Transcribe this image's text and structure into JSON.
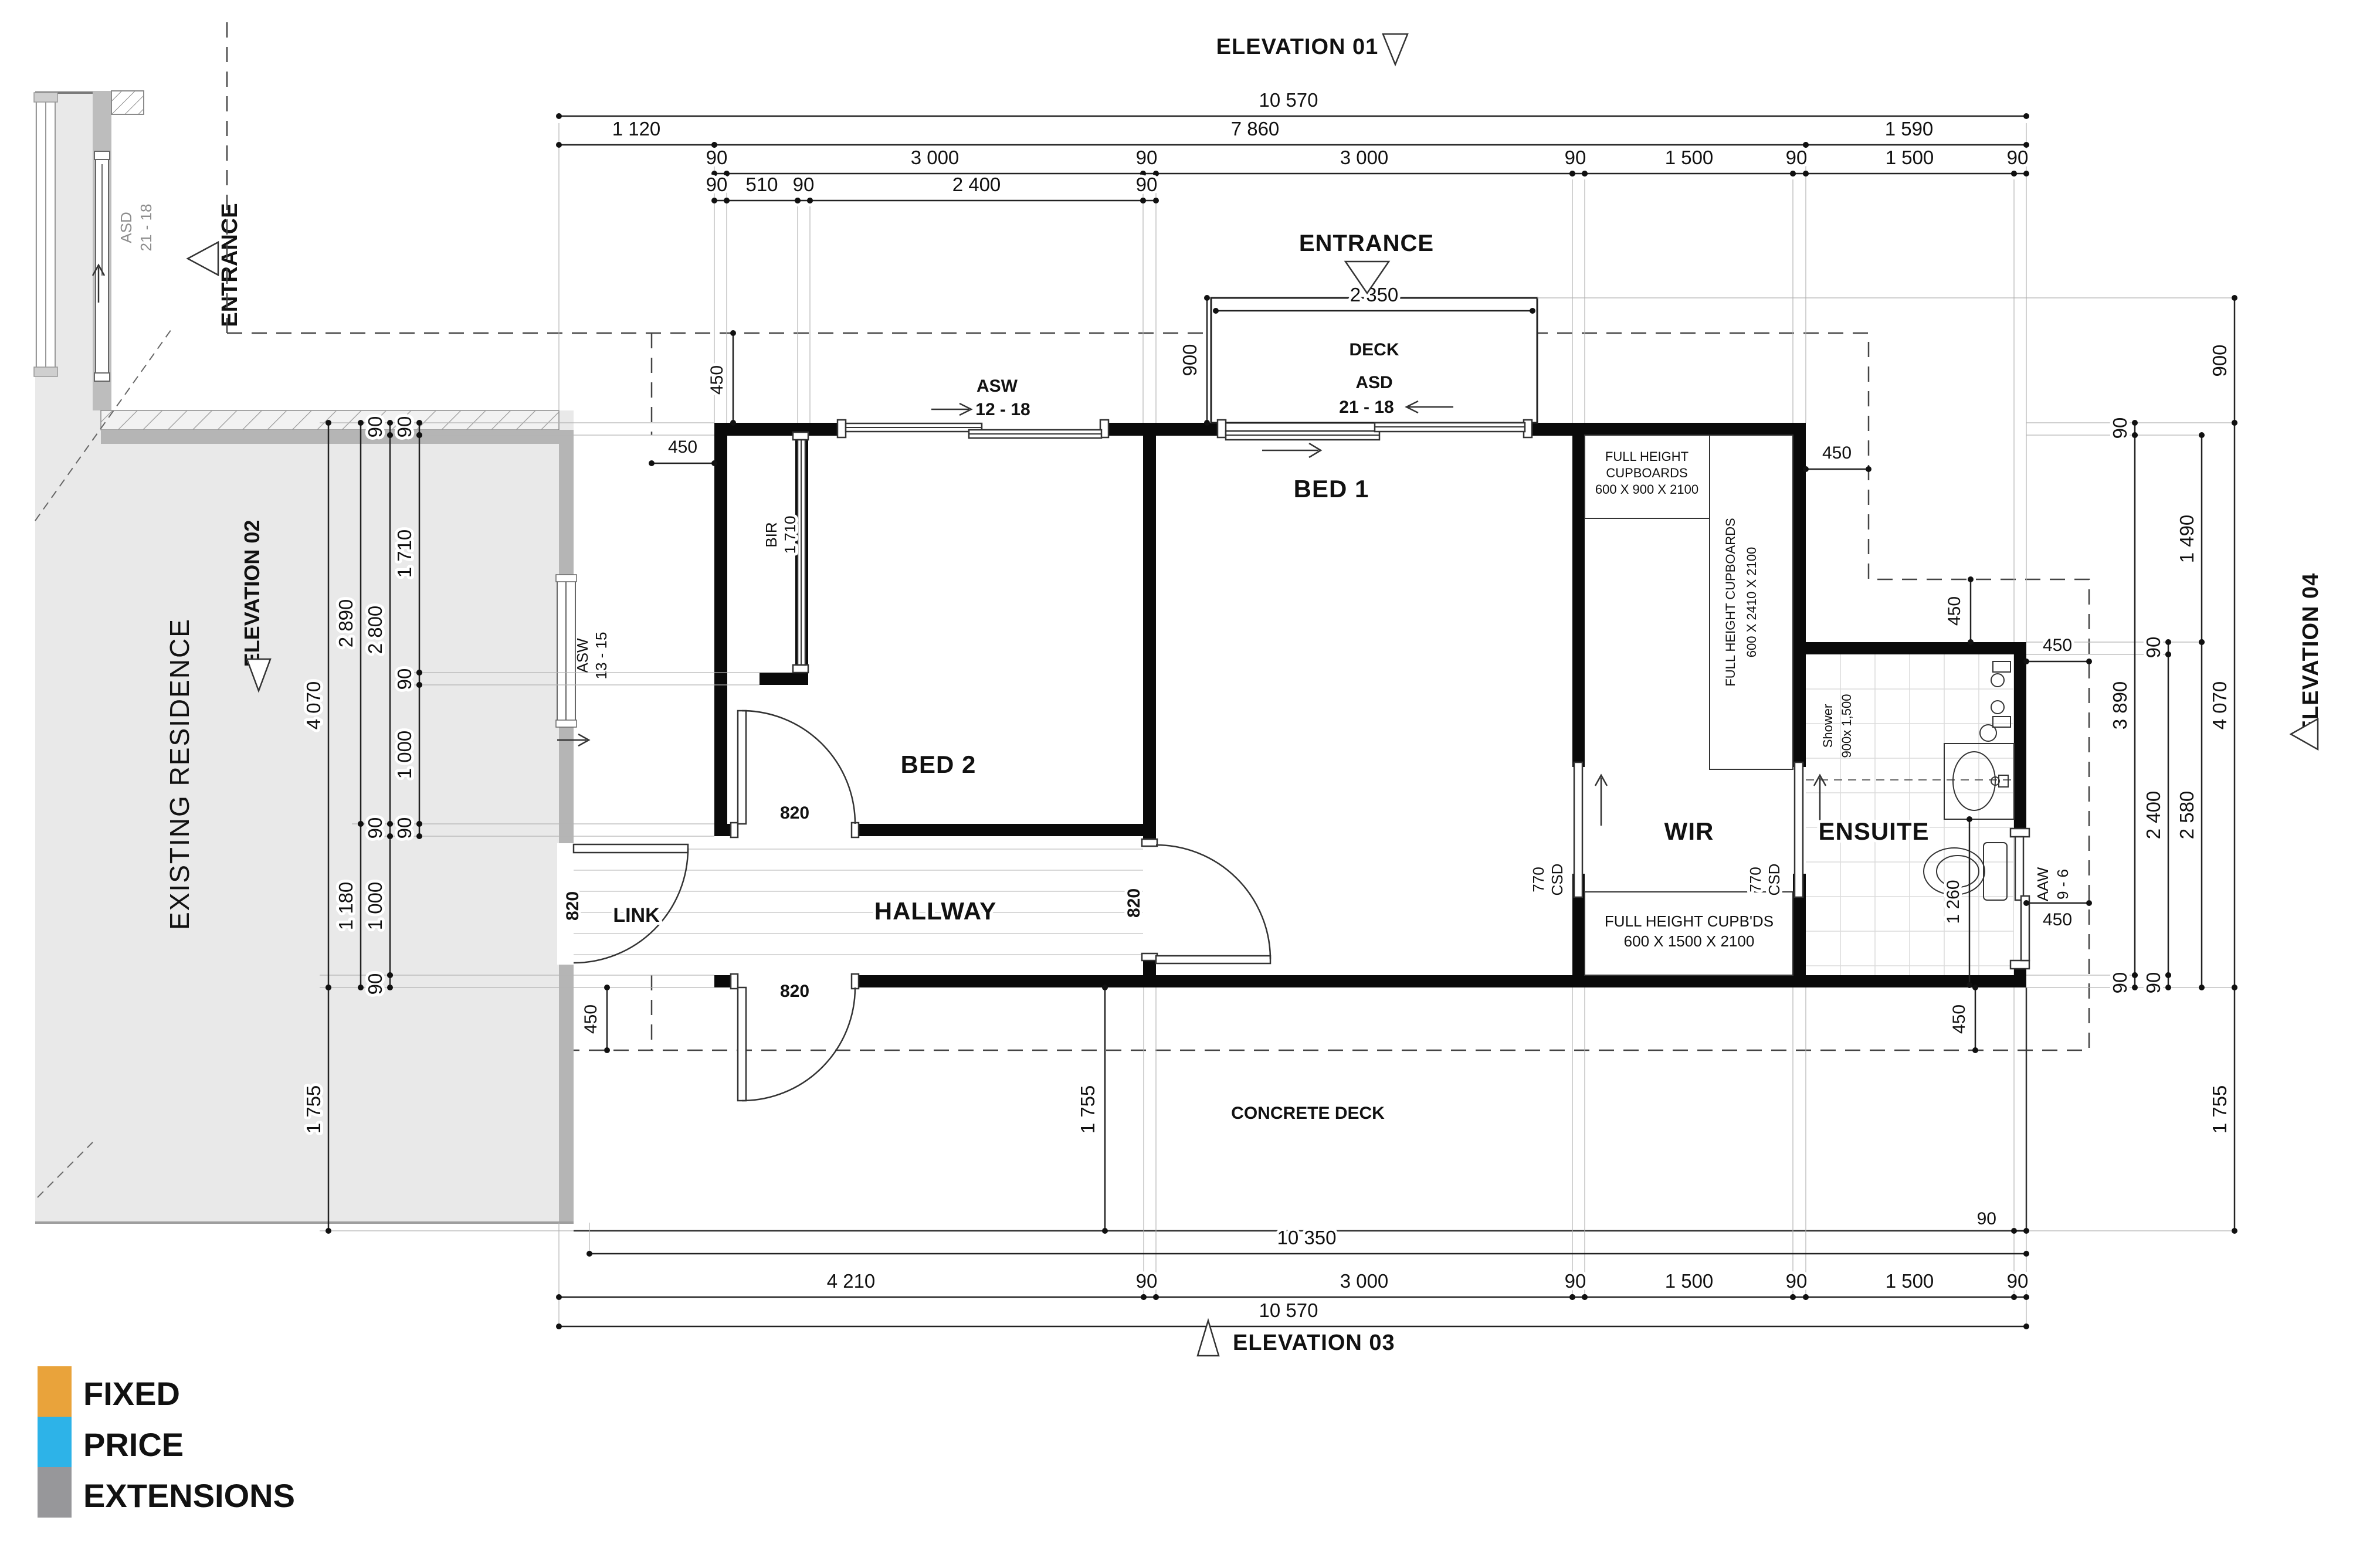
{
  "drawing": {
    "elevations": {
      "e01": "ELEVATION 01",
      "e02": "ELEVATION 02",
      "e03": "ELEVATION 03",
      "e04": "ELEVATION 04"
    },
    "entrance": "ENTRANCE",
    "existing_residence": "EXISTING RESIDENCE",
    "deck": "DECK",
    "concrete_deck": "CONCRETE DECK",
    "rooms": {
      "bed1": "BED 1",
      "bed2": "BED 2",
      "link": "LINK",
      "hallway": "HALLWAY",
      "wir": "WIR",
      "ensuite": "ENSUITE"
    },
    "fixtures": {
      "bir": "BIR",
      "bir_len": "1 710",
      "shower": [
        "Shower",
        "900x 1,500"
      ],
      "cup_900": [
        "FULL HEIGHT",
        "CUPBOARDS",
        "600 X 900 X 2100"
      ],
      "cup_2410": [
        "FULL HEIGHT CUPBOARDS",
        "600 X 2410 X 2100"
      ],
      "cup_1500": [
        "FULL HEIGHT CUPB'DS",
        "600 X 1500 X 2100"
      ],
      "csd": [
        "770",
        "CSD"
      ]
    },
    "openings": {
      "asw_12_18": [
        "ASW",
        "12 - 18"
      ],
      "asd_21_18": [
        "ASD",
        "21 - 18"
      ],
      "asw_13_15": [
        "ASW",
        "13 - 15"
      ],
      "aaw_9_6": [
        "AAW",
        "9 - 6"
      ]
    },
    "dims": {
      "d10570": "10 570",
      "d10350": "10 350",
      "d7860": "7 860",
      "d4210": "4 210",
      "d4070": "4 070",
      "d3890": "3 890",
      "d3000": "3 000",
      "d2890": "2 890",
      "d2800": "2 800",
      "d2580": "2 580",
      "d2400": "2 400",
      "d2350": "2 350",
      "d1755": "1 755",
      "d1710": "1 710",
      "d1590": "1 590",
      "d1500": "1 500",
      "d1490": "1 490",
      "d1260": "1 260",
      "d1180": "1 180",
      "d1120": "1 120",
      "d1000": "1 000",
      "d900": "900",
      "d820": "820",
      "d510": "510",
      "d450": "450",
      "d90": "90"
    },
    "logo": {
      "line1": "FIXED",
      "line2": "PRICE",
      "line3": "EXTENSIONS",
      "orange": "#E9A33B",
      "blue": "#2DB3E8",
      "gray": "#97979A"
    }
  }
}
